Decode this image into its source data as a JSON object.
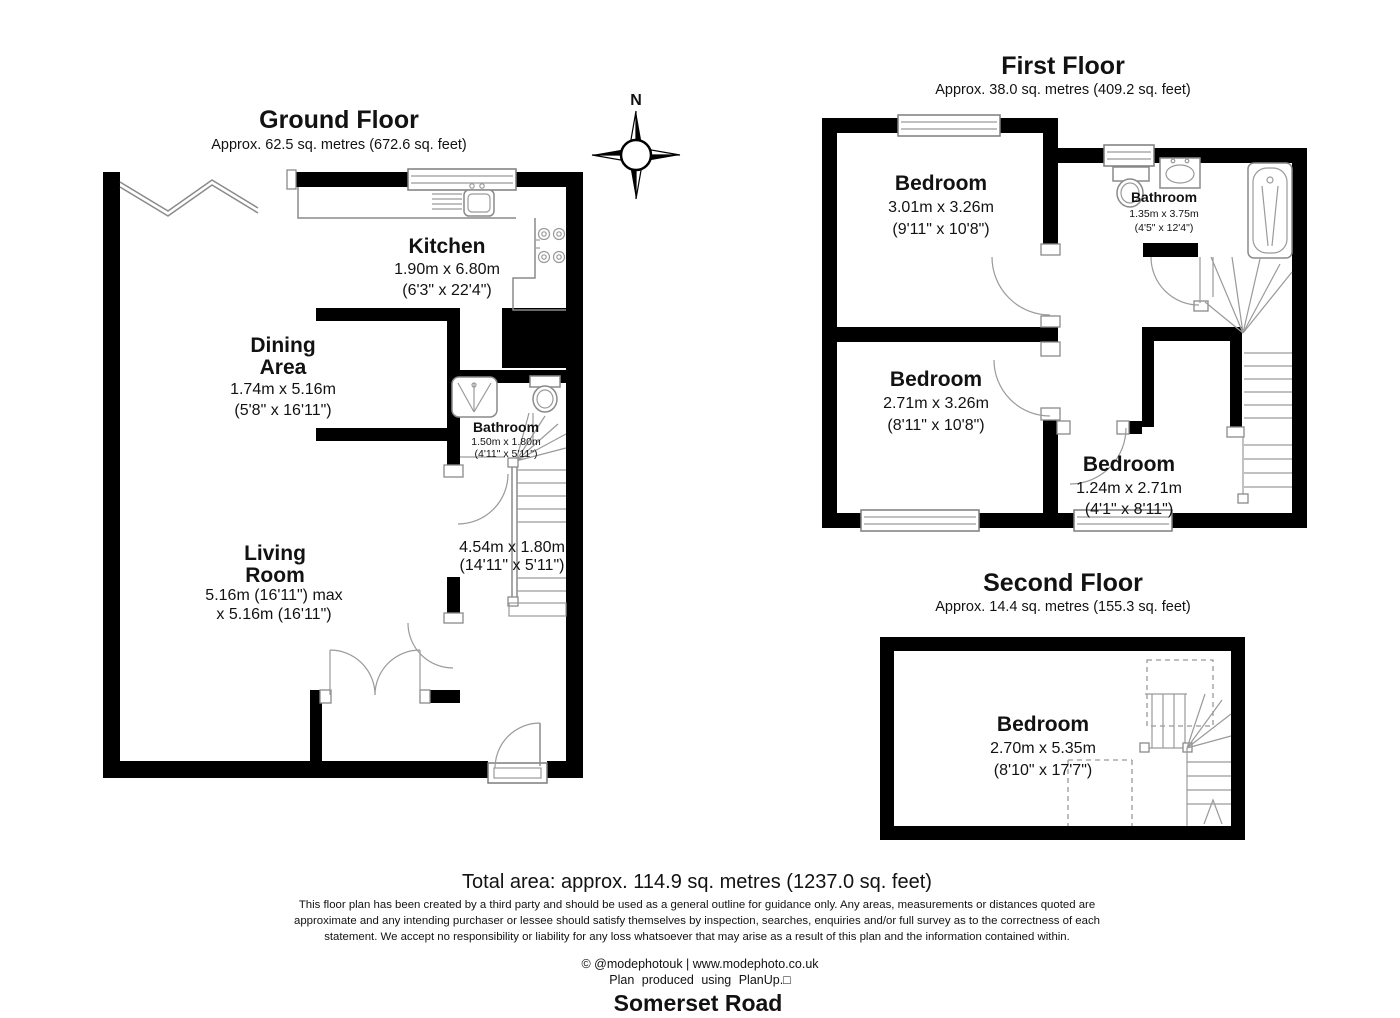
{
  "page": {
    "address": "Somerset Road"
  },
  "compass": {
    "north": "N"
  },
  "floors": {
    "ground": {
      "title": "Ground Floor",
      "area": "Approx. 62.5 sq. metres (672.6 sq. feet)"
    },
    "first": {
      "title": "First Floor",
      "area": "Approx. 38.0 sq. metres (409.2 sq. feet)"
    },
    "second": {
      "title": "Second Floor",
      "area": "Approx. 14.4 sq. metres (155.3 sq. feet)"
    }
  },
  "rooms": {
    "kitchen": {
      "name": "Kitchen",
      "dims_m": "1.90m x 6.80m",
      "dims_ft": "(6'3\" x 22'4\")"
    },
    "dining": {
      "name1": "Dining",
      "name2": "Area",
      "dims_m": "1.74m x 5.16m",
      "dims_ft": "(5'8\" x 16'11\")"
    },
    "living": {
      "name1": "Living",
      "name2": "Room",
      "dims_m": "5.16m (16'11\") max",
      "dims_ft": "x 5.16m (16'11\")"
    },
    "gf_bathroom": {
      "name": "Bathroom",
      "dims_m": "1.50m x 1.80m",
      "dims_ft": "(4'11\" x 5'11\")"
    },
    "hall": {
      "dims_m": "4.54m x 1.80m",
      "dims_ft": "(14'11\" x 5'11\")"
    },
    "ff_bedroom1": {
      "name": "Bedroom",
      "dims_m": "3.01m x 3.26m",
      "dims_ft": "(9'11\" x 10'8\")"
    },
    "ff_bathroom": {
      "name": "Bathroom",
      "dims_m": "1.35m x 3.75m",
      "dims_ft": "(4'5\" x 12'4\")"
    },
    "ff_bedroom2": {
      "name": "Bedroom",
      "dims_m": "2.71m x 3.26m",
      "dims_ft": "(8'11\" x 10'8\")"
    },
    "ff_bedroom3": {
      "name": "Bedroom",
      "dims_m": "1.24m x 2.71m",
      "dims_ft": "(4'1\" x 8'11\")"
    },
    "sf_bedroom": {
      "name": "Bedroom",
      "dims_m": "2.70m x 5.35m",
      "dims_ft": "(8'10\" x 17'7\")"
    }
  },
  "footer": {
    "total_area": "Total area: approx. 114.9 sq. metres (1237.0 sq. feet)",
    "disclaimer_lines": [
      "This floor plan has been created by a third party and should be used as a general outline for guidance only. Any areas, measurements or distances quoted are",
      "approximate and any intending purchaser or lessee should satisfy themselves by inspection, searches, enquiries and/or full survey as to the correctness of each",
      "statement. We accept no responsibility or liability for any loss whatsoever that may arise as a result of this plan and the information contained within."
    ],
    "credit": "© @modephotouk | www.modephoto.co.uk",
    "produced": "Plan produced using PlanUp.□"
  },
  "colors": {
    "wall": "#000000",
    "line": "#8a8a8a",
    "text": "#121212"
  }
}
